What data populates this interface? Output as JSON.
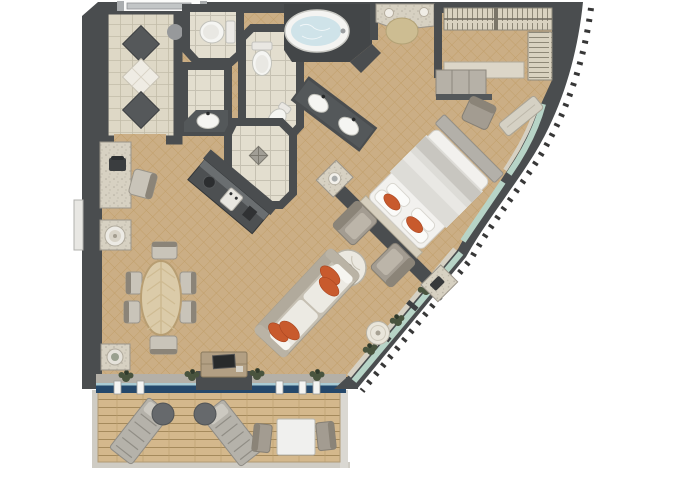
{
  "meta": {
    "label": "luxury-suite-floor-plan",
    "type": "floor-plan-rendering",
    "canvas": {
      "width": 680,
      "height": 486
    },
    "orientation": "top-down",
    "hull_side": "curved-right"
  },
  "colors": {
    "wall": "#4a4d4f",
    "wall_dark": "#434648",
    "counter_dark": "#54585a",
    "carpet": "#cbae85",
    "carpet_line": "#b8904f",
    "tile": "#e3decf",
    "tile_line": "#c6c1b2",
    "entry_floor": "#ded8c6",
    "deck": "#d4b88c",
    "deck_line": "#a58a5c",
    "granite": "#d7d1c2",
    "marble": "#ebe8e0",
    "fixture_white": "#f5f5f2",
    "water": "#cfe3e9",
    "navy_door": "#24486b",
    "glass": "#b7d4c7",
    "sill": "#d6d1c4",
    "accent_orange": "#c85a2d",
    "furniture_gray": "#a39c91",
    "furniture_light": "#c9c4b9",
    "wood": "#b29f83",
    "stool_beige": "#cdbd92",
    "plant": "#49543e",
    "hull_tick": "#141414"
  },
  "rooms": [
    {
      "name": "entry-foyer",
      "floor": "marble-tile",
      "features": [
        "dark-diamond-inlay",
        "white-diamond-inlay",
        "dark-diamond-inlay",
        "column"
      ]
    },
    {
      "name": "guest-wc",
      "floor": "tile",
      "fixtures": [
        "toilet"
      ]
    },
    {
      "name": "washroom",
      "floor": "tile",
      "fixtures": [
        "washbasin-counter"
      ]
    },
    {
      "name": "toilet-room",
      "floor": "tile",
      "fixtures": [
        "toilet",
        "bidet"
      ]
    },
    {
      "name": "shower-room",
      "floor": "tile",
      "fixtures": [
        "walk-in-shower",
        "floor-drain",
        "glass-door"
      ]
    },
    {
      "name": "bath-alcove",
      "fixtures": [
        "oval-bathtub",
        "faucet"
      ]
    },
    {
      "name": "vanity",
      "fixtures": [
        "double-sink-counter"
      ]
    },
    {
      "name": "dressing-area",
      "fixtures": [
        "makeup-counter",
        "vanity-stool",
        "sconce",
        "sconce"
      ]
    },
    {
      "name": "walk-in-closet",
      "fixtures": [
        "hanging-rack-top",
        "hanging-rack-side",
        "bench-shelf"
      ]
    },
    {
      "name": "bedroom",
      "furniture": [
        "king-bed",
        "headboard-wall",
        "nightstand-with-lamp",
        "nightstand-with-phone",
        "desk",
        "desk-chair",
        "window-bench"
      ]
    },
    {
      "name": "living-room",
      "furniture": [
        "sofa",
        "armchair",
        "armchair",
        "marble-coffee-table",
        "side-table",
        "tv-console",
        "tv"
      ]
    },
    {
      "name": "dining-area",
      "furniture": [
        "oval-dining-table",
        "dining-chair",
        "dining-chair",
        "dining-chair",
        "dining-chair",
        "dining-chair",
        "dining-chair"
      ]
    },
    {
      "name": "wet-bar",
      "furniture": [
        "granite-desk",
        "telephone",
        "bar-chair",
        "cabinet-with-ice-bucket",
        "console-with-bowl"
      ]
    },
    {
      "name": "kitchenette",
      "furniture": [
        "counter",
        "espresso-machine",
        "hob"
      ]
    },
    {
      "name": "balcony",
      "floor": "teak-deck",
      "furniture": [
        "sun-lounger",
        "sun-lounger",
        "round-side-table",
        "round-side-table",
        "outdoor-table",
        "outdoor-chair",
        "outdoor-chair"
      ]
    }
  ],
  "counts": {
    "accent_pillows_bed": 2,
    "accent_pillows_sofa": 4,
    "dining_chairs": 6,
    "sun_loungers": 2,
    "window_plants": 7,
    "balcony_sliding_door_frames": 5,
    "entry_doors": 1
  }
}
